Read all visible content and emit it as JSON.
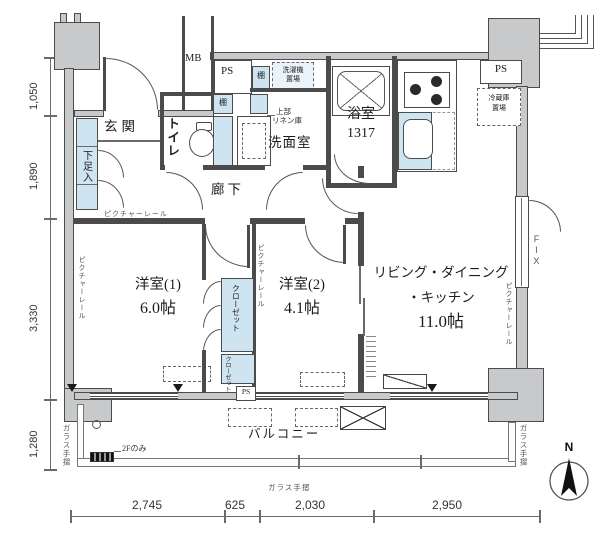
{
  "plan": {
    "rooms": {
      "genkan": "玄関",
      "toilet": "トイレ",
      "hall": "廊下",
      "wash": "洗面室",
      "bath": "浴室",
      "bath_size": "1317",
      "r1": "洋室(1)",
      "r1_size": "6.0帖",
      "r2": "洋室(2)",
      "r2_size": "4.1帖",
      "ldk1": "リビング・ダイニング",
      "ldk2": "・キッチン",
      "ldk_size": "11.0帖",
      "balcony": "バルコニー"
    },
    "labels": {
      "mb": "MB",
      "ps": "PS",
      "shelf": "棚",
      "washer": [
        "洗濯機",
        "置場"
      ],
      "linen": [
        "上部",
        "リネン庫"
      ],
      "fridge": [
        "冷蔵庫",
        "置場"
      ],
      "shoe": "下足入",
      "closet": "クローゼット",
      "rail": "ピクチャーレール",
      "fix": "FIX",
      "glass": "ガラス手摺",
      "f2": "2Fのみ",
      "north": "N"
    },
    "dims": {
      "left": [
        "1,050",
        "1,890",
        "3,330",
        "1,280"
      ],
      "bottom": [
        "2,745",
        "625",
        "2,030",
        "2,950"
      ]
    },
    "colors": {
      "wall": "#4b4b4b",
      "column_gray": "#c7c9cb",
      "fixture_blue": "#cfe4f1"
    }
  }
}
